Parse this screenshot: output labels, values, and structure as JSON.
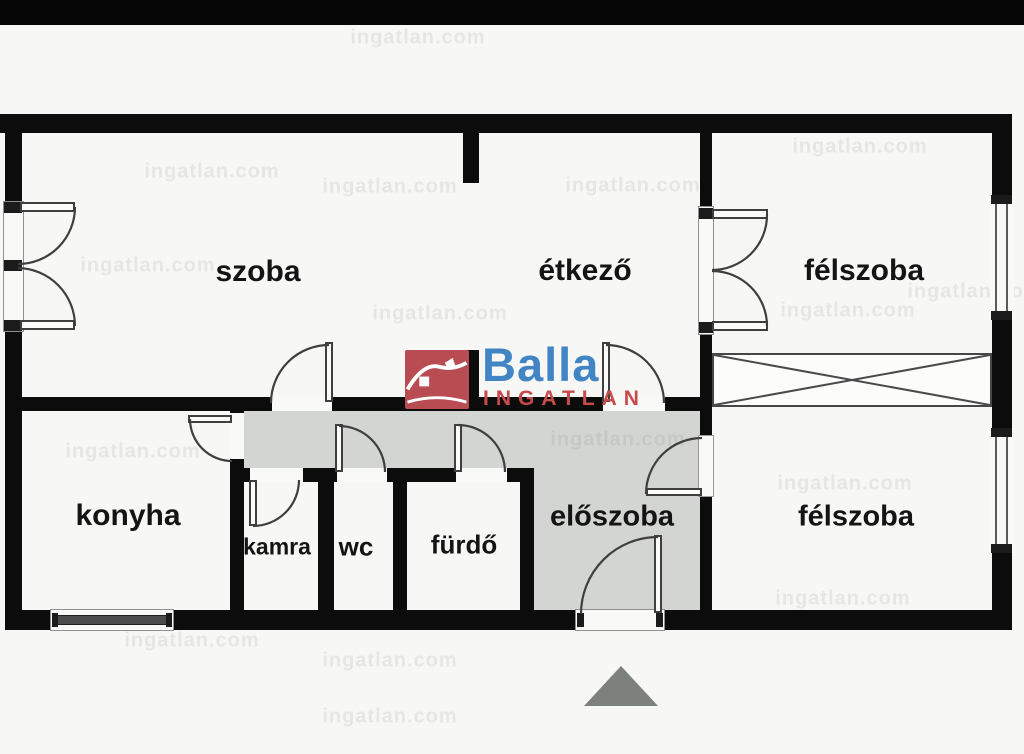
{
  "brand": {
    "name": "Balla",
    "subtitle": "INGATLAN",
    "name_color": "#4285c5",
    "subtitle_color": "#c84b4b",
    "box_color": "#b94b52"
  },
  "watermark": {
    "text": "ingatlan.com"
  },
  "rooms": [
    {
      "id": "szoba",
      "label": "szoba"
    },
    {
      "id": "etkezo",
      "label": "étkező"
    },
    {
      "id": "felszoba-top",
      "label": "félszoba"
    },
    {
      "id": "konyha",
      "label": "konyha"
    },
    {
      "id": "kamra",
      "label": "kamra"
    },
    {
      "id": "wc",
      "label": "wc"
    },
    {
      "id": "furdo",
      "label": "fürdő"
    },
    {
      "id": "eloszoba",
      "label": "előszoba"
    },
    {
      "id": "felszoba-bottom",
      "label": "félszoba"
    }
  ],
  "colors": {
    "wall": "#0c0c0c",
    "hallway_fill": "#d3d5d2",
    "door_line": "#3f3f3f",
    "triangle": "#7c817c",
    "background": "#f7f7f5"
  }
}
